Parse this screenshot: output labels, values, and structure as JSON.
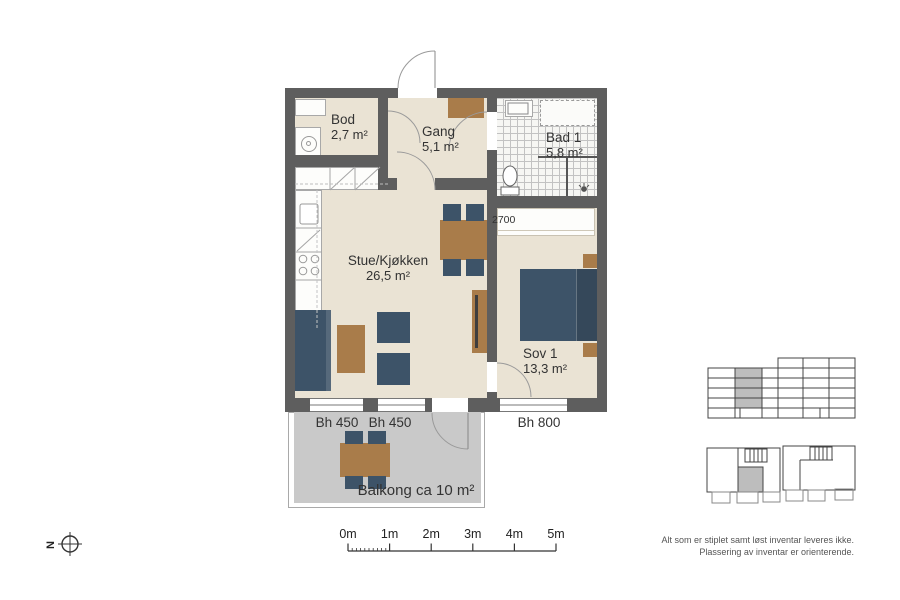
{
  "colors": {
    "wall": "#5e5e5e",
    "floor": "#eae3d4",
    "furniture_blue": "#3d5368",
    "furniture_brown": "#a97c4a",
    "balcony_gray": "#c9c9c9",
    "tile_line": "#c2c2c2",
    "text": "#333333"
  },
  "rooms": {
    "bod": {
      "name": "Bod",
      "area": "2,7 m²"
    },
    "gang": {
      "name": "Gang",
      "area": "5,1 m²"
    },
    "bad": {
      "name": "Bad 1",
      "area": "5,8 m²"
    },
    "stue": {
      "name": "Stue/Kjøkken",
      "area": "26,5 m²"
    },
    "sov": {
      "name": "Sov 1",
      "area": "13,3 m²"
    },
    "balkong": {
      "name": "Balkong ca 10 m²"
    }
  },
  "dimensions": {
    "wardrobe_width": "2700",
    "window_sill_1": "Bh 450",
    "window_sill_2": "Bh 450",
    "window_sill_3": "Bh 800"
  },
  "scale_bar": {
    "labels": [
      "0m",
      "1m",
      "2m",
      "3m",
      "4m",
      "5m"
    ]
  },
  "north": {
    "label": "N"
  },
  "disclaimer": {
    "line1": "Alt som er stiplet samt løst inventar leveres ikke.",
    "line2": "Plassering av inventar er orienterende."
  }
}
